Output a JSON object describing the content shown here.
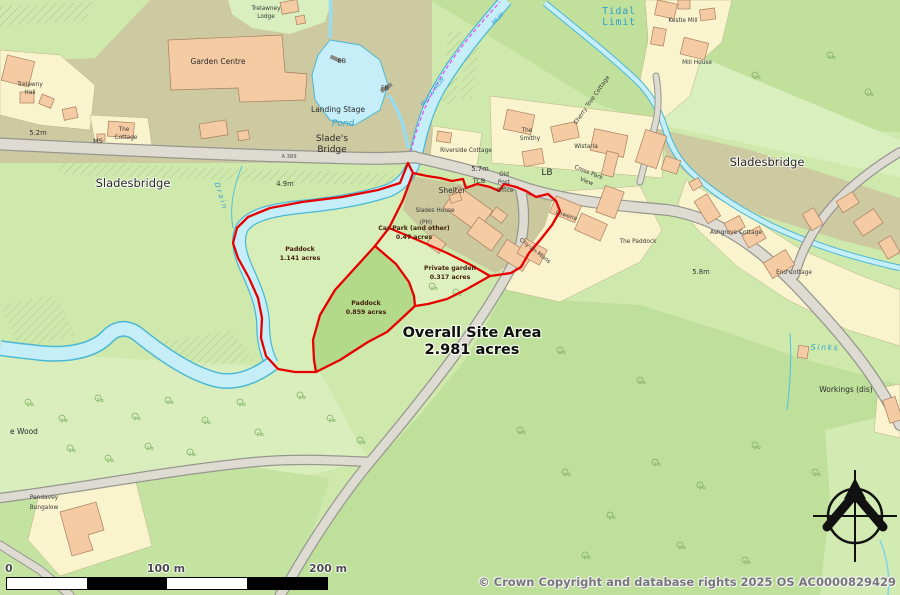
{
  "map": {
    "title": "Sladesbridge site plan",
    "labels": [
      {
        "t": "Trelawney",
        "x": 266,
        "y": 10,
        "c": "tiny"
      },
      {
        "t": "Lodge",
        "x": 266,
        "y": 18,
        "c": "tiny"
      },
      {
        "t": "Garden Centre",
        "x": 218,
        "y": 64,
        "c": "place"
      },
      {
        "t": "Trelawny",
        "x": 30,
        "y": 86,
        "c": "tiny"
      },
      {
        "t": "Hall",
        "x": 30,
        "y": 94,
        "c": "tiny"
      },
      {
        "t": "FB",
        "x": 342,
        "y": 63,
        "c": "lbl"
      },
      {
        "t": "FB",
        "x": 385,
        "y": 90,
        "c": "lbl"
      },
      {
        "t": "Landing Stage",
        "x": 338,
        "y": 112,
        "c": "place"
      },
      {
        "t": "Pond",
        "x": 343,
        "y": 126,
        "c": "water-pond"
      },
      {
        "t": "Slade's",
        "x": 332,
        "y": 141,
        "c": "med"
      },
      {
        "t": "Bridge",
        "x": 332,
        "y": 152,
        "c": "med"
      },
      {
        "t": "The",
        "x": 124,
        "y": 131,
        "c": "tiny"
      },
      {
        "t": "Cottage",
        "x": 126,
        "y": 139,
        "c": "tiny"
      },
      {
        "t": "MS",
        "x": 98,
        "y": 143,
        "c": "lbl"
      },
      {
        "t": "5.2m",
        "x": 38,
        "y": 135,
        "c": "height"
      },
      {
        "t": "A 389",
        "x": 289,
        "y": 158,
        "c": "road-num"
      },
      {
        "t": "Sladesbridge",
        "x": 133,
        "y": 187,
        "c": "big"
      },
      {
        "t": "4.9m",
        "x": 285,
        "y": 186,
        "c": "height"
      },
      {
        "t": "Drain",
        "x": 219,
        "y": 197,
        "c": "water-drain",
        "r": 72
      },
      {
        "t": "Mud & MLW",
        "x": 434,
        "y": 93,
        "c": "water-mlw",
        "r": -52
      },
      {
        "t": "MLW",
        "x": 499,
        "y": 20,
        "c": "water-mlw",
        "r": -45
      },
      {
        "t": "Tidal",
        "x": 619,
        "y": 14,
        "c": "blue-mono"
      },
      {
        "t": "Limit",
        "x": 619,
        "y": 25,
        "c": "blue-mono"
      },
      {
        "t": "Kestle Mill",
        "x": 683,
        "y": 22,
        "c": "tiny"
      },
      {
        "t": "Mill House",
        "x": 697,
        "y": 64,
        "c": "tiny"
      },
      {
        "t": "Riverside Cottage",
        "x": 466,
        "y": 152,
        "c": "tiny"
      },
      {
        "t": "The",
        "x": 527,
        "y": 132,
        "c": "tiny"
      },
      {
        "t": "Smithy",
        "x": 530,
        "y": 140,
        "c": "tiny"
      },
      {
        "t": "Wistaria",
        "x": 586,
        "y": 148,
        "c": "tiny"
      },
      {
        "t": "Cherry Tree Cottage",
        "x": 593,
        "y": 101,
        "c": "tiny",
        "r": -55
      },
      {
        "t": "Sladesbridge",
        "x": 767,
        "y": 166,
        "c": "big"
      },
      {
        "t": "5.7m",
        "x": 480,
        "y": 171,
        "c": "height"
      },
      {
        "t": "TCB",
        "x": 479,
        "y": 183,
        "c": "lbl"
      },
      {
        "t": "Old",
        "x": 504,
        "y": 176,
        "c": "tiny"
      },
      {
        "t": "Post",
        "x": 504,
        "y": 184,
        "c": "tiny"
      },
      {
        "t": "Office",
        "x": 505,
        "y": 192,
        "c": "tiny"
      },
      {
        "t": "LB",
        "x": 547,
        "y": 175,
        "c": "med"
      },
      {
        "t": "Shelter",
        "x": 452,
        "y": 193,
        "c": "place"
      },
      {
        "t": "Slades House",
        "x": 435,
        "y": 212,
        "c": "tiny"
      },
      {
        "t": "(PH)",
        "x": 426,
        "y": 224,
        "c": "tiny"
      },
      {
        "t": "Cross Park",
        "x": 588,
        "y": 174,
        "c": "tiny",
        "r": 22
      },
      {
        "t": "View",
        "x": 586,
        "y": 183,
        "c": "tiny",
        "r": 22
      },
      {
        "t": "Lowena",
        "x": 566,
        "y": 217,
        "c": "tiny",
        "r": 18
      },
      {
        "t": "Chy-an-Mons",
        "x": 534,
        "y": 252,
        "c": "tiny",
        "r": 38
      },
      {
        "t": "The Paddock",
        "x": 638,
        "y": 243,
        "c": "tiny"
      },
      {
        "t": "Ashgrove Cottage",
        "x": 736,
        "y": 234,
        "c": "tiny"
      },
      {
        "t": "End Cottage",
        "x": 794,
        "y": 274,
        "c": "tiny"
      },
      {
        "t": "5.8m",
        "x": 701,
        "y": 274,
        "c": "height"
      },
      {
        "t": "Car Park (and other)",
        "x": 414,
        "y": 230,
        "c": "site-lbl"
      },
      {
        "t": "0.47 acres",
        "x": 414,
        "y": 239,
        "c": "site-lbl"
      },
      {
        "t": "Paddock",
        "x": 300,
        "y": 251,
        "c": "site-lbl"
      },
      {
        "t": "1.141 acres",
        "x": 300,
        "y": 260,
        "c": "site-lbl"
      },
      {
        "t": "Paddock",
        "x": 366,
        "y": 305,
        "c": "site-lbl"
      },
      {
        "t": "0.859 acres",
        "x": 366,
        "y": 314,
        "c": "site-lbl"
      },
      {
        "t": "Private garden",
        "x": 450,
        "y": 270,
        "c": "site-lbl"
      },
      {
        "t": "0.317 acres",
        "x": 450,
        "y": 279,
        "c": "site-lbl"
      },
      {
        "t": "Overall Site Area",
        "x": 472,
        "y": 337,
        "c": "overall"
      },
      {
        "t": "2.981 acres",
        "x": 472,
        "y": 354,
        "c": "overall"
      },
      {
        "t": "Sinks",
        "x": 825,
        "y": 350,
        "c": "water-sinks"
      },
      {
        "t": "Workings (dis)",
        "x": 846,
        "y": 392,
        "c": "place"
      },
      {
        "t": "e Wood",
        "x": 24,
        "y": 434,
        "c": "place"
      },
      {
        "t": "Pendavey",
        "x": 44,
        "y": 499,
        "c": "tiny"
      },
      {
        "t": "Bungalow",
        "x": 44,
        "y": 509,
        "c": "tiny"
      }
    ]
  },
  "scalebar": {
    "zero": "0",
    "hundred": "100 m",
    "two_hundred": "200 m"
  },
  "copyright": "© Crown Copyright and database rights 2025 OS AC0000829429",
  "colors": {
    "site_boundary_red": "#e60000",
    "water_fill": "#c6eef8",
    "water_edge": "#4ab8d6",
    "building": "#f5cba3",
    "road": "#dddbd2",
    "village_olive": "#cdc9a0",
    "field_light": "#d9efbc",
    "field_mid": "#c0e09c",
    "parish_boundary_magenta": "#f23cf2",
    "water_label_blue": "#38a2cf"
  }
}
